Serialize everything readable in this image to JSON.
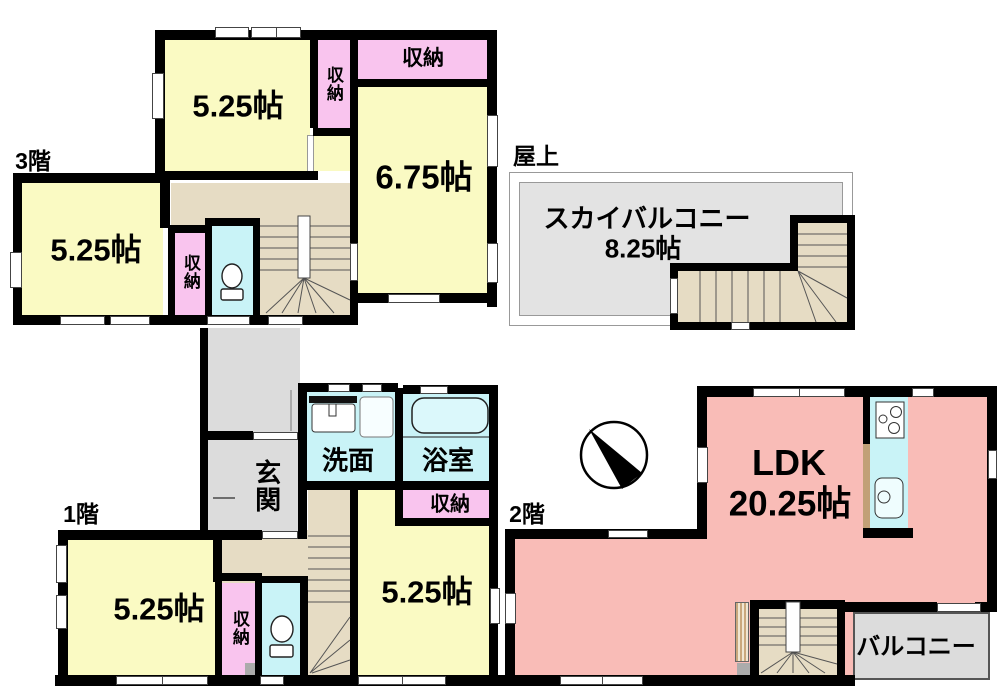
{
  "floors": {
    "third": {
      "label": "3階",
      "room_top": "5.25帖",
      "room_right": "6.75帖",
      "room_left": "5.25帖",
      "storage": "収納"
    },
    "roof": {
      "label": "屋上",
      "sky_balcony_name": "スカイバルコニー",
      "sky_balcony_size": "8.25帖"
    },
    "first": {
      "label": "1階",
      "entrance": "玄関",
      "washroom": "洗面",
      "bathroom": "浴室",
      "storage": "収納",
      "room_left": "5.25帖",
      "room_right": "5.25帖"
    },
    "second": {
      "label": "2階",
      "ldk_name": "LDK",
      "ldk_size": "20.25帖",
      "balcony": "バルコニー"
    }
  },
  "colors": {
    "room_yellow": "#FAFAC3",
    "storage_pink": "#F9C4EE",
    "wet_area_cyan": "#C9F3F7",
    "ldk_salmon": "#F9BCB7",
    "stairs_beige": "#E6DCC4",
    "outdoor_gray": "#DCDCDC",
    "sky_balcony_gray": "#E3E3E3",
    "wall_black": "#000000",
    "kitchen_counter_tan": "#C2A077"
  }
}
